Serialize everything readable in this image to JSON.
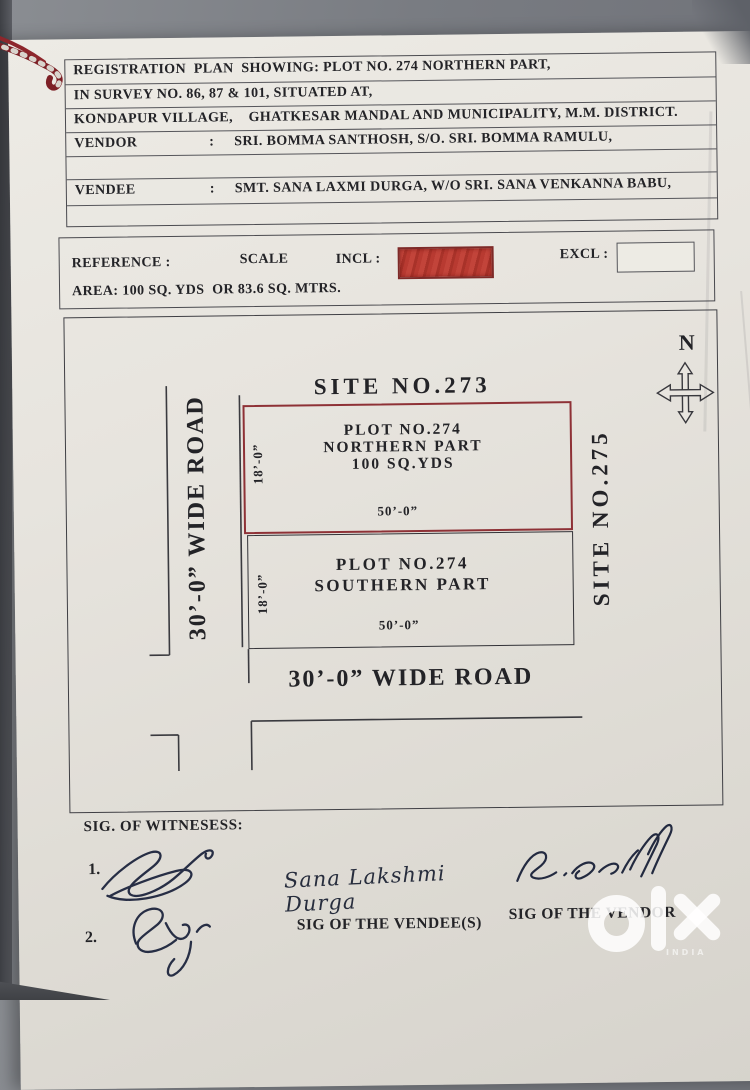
{
  "header": {
    "row1": "REGISTRATION  PLAN  SHOWING: PLOT NO. 274 NORTHERN PART,",
    "row2": "IN SURVEY NO. 86, 87 & 101, SITUATED AT,",
    "row3": "KONDAPUR VILLAGE,    GHATKESAR MANDAL AND MUNICIPALITY, M.M. DISTRICT.",
    "vendor_label": "VENDOR",
    "vendor_colon": ":",
    "vendor_value": "SRI. BOMMA SANTHOSH, S/O. SRI. BOMMA RAMULU,",
    "vendee_label": "VENDEE",
    "vendee_colon": ":",
    "vendee_value": "SMT. SANA LAXMI DURGA, W/O SRI. SANA VENKANNA BABU,"
  },
  "reference": {
    "reference_label": "REFERENCE :",
    "scale_label": "SCALE",
    "incl_label": "INCL :",
    "excl_label": "EXCL :",
    "area_text": "AREA: 100 SQ. YDS  OR 83.6 SQ. MTRS.",
    "incl_fill_color": "#b23730",
    "excl_fill_color": "#edebe4"
  },
  "plan": {
    "compass_label": "N",
    "site_north": "SITE NO.273",
    "site_east": "SITE NO.275",
    "west_road": "30’-0”  WIDE ROAD",
    "south_road": "30’-0”  WIDE ROAD",
    "north_plot": {
      "line1": "PLOT NO.274",
      "line2": "NORTHERN PART",
      "line3": "100 SQ.YDS",
      "width": "50’-0”",
      "depth": "18’-0”",
      "border_color": "#8e3136"
    },
    "south_plot": {
      "line1": "PLOT NO.274",
      "line2": "SOUTHERN PART",
      "width": "50’-0”",
      "depth": "18’-0”",
      "border_color": "#323237"
    }
  },
  "signatures": {
    "witness_heading": "SIG. OF WITNESESS:",
    "witness_1_num": "1.",
    "witness_2_num": "2.",
    "vendee_handwritten": "Sana Lakshmi Durga",
    "vendee_caption": "SIG OF THE VENDEE(S)",
    "vendor_signature": "B.Santosh",
    "vendor_caption": "SIG OF THE VENDOR"
  },
  "watermark": {
    "brand": "olx",
    "country_label": "INDIA"
  }
}
